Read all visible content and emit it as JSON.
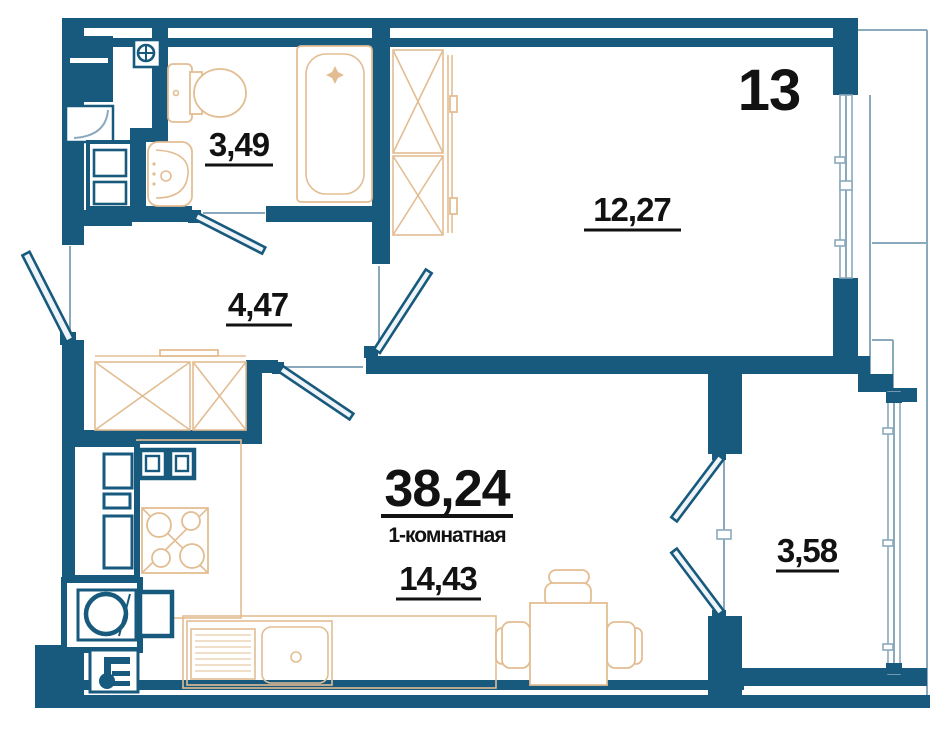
{
  "plan": {
    "apartment_number": "13",
    "apartment_type": "1-комнатная",
    "total_area": "38,24",
    "rooms": [
      {
        "name": "bathroom",
        "area": "3,49"
      },
      {
        "name": "hallway",
        "area": "4,47"
      },
      {
        "name": "bedroom",
        "area": "12,27"
      },
      {
        "name": "kitchen-living-room",
        "area": "14,43"
      },
      {
        "name": "balcony",
        "area": "3,58"
      }
    ],
    "colors": {
      "walls": "#175a7d",
      "furniture": "#e3bd92",
      "glazing": "#8aa9bd",
      "labels": "#121212",
      "background": "#ffffff"
    }
  }
}
